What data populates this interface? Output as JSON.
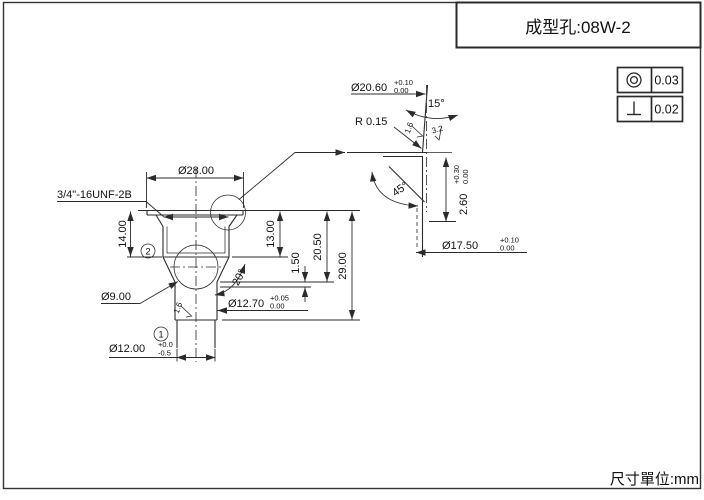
{
  "page": {
    "units_note": "尺寸單位:mm"
  },
  "title_block": {
    "title": "成型孔:08W-2"
  },
  "tolerance_frames": [
    {
      "symbol": "concentricity-icon",
      "value": "0.03"
    },
    {
      "symbol": "perpendicularity-icon",
      "value": "0.02"
    }
  ],
  "main_view": {
    "balloons": [
      {
        "label": "1"
      },
      {
        "label": "2"
      }
    ],
    "dims": {
      "d28": {
        "label": "Ø28.00"
      },
      "thread": {
        "label": "3/4\"-16UNF-2B"
      },
      "d14": {
        "label": "14.00"
      },
      "d13": {
        "label": "13.00"
      },
      "d150": {
        "label": "1.50"
      },
      "d2050": {
        "label": "20.50"
      },
      "d2900": {
        "label": "29.00"
      },
      "d9": {
        "label": "Ø9.00"
      },
      "d1270": {
        "label": "Ø12.70",
        "tol_plus": "+0.05",
        "tol_minus": "0.00"
      },
      "d1200": {
        "label": "Ø12.00",
        "tol_plus": "+0.0",
        "tol_minus": "-0.5"
      },
      "a20": {
        "label": "20°"
      },
      "rough16": {
        "label": "1.6"
      }
    }
  },
  "detail_view": {
    "dims": {
      "d2060": {
        "label": "Ø20.60",
        "tol_plus": "+0.10",
        "tol_minus": "0.00"
      },
      "a15": {
        "label": "15°"
      },
      "r015": {
        "label": "R 0.15"
      },
      "rough16": {
        "label": "1.6"
      },
      "rough32": {
        "label": "3.2"
      },
      "a45": {
        "label": "45°"
      },
      "d260": {
        "label": "2.60",
        "tol_plus": "+0.30",
        "tol_minus": "0.00"
      },
      "d1750": {
        "label": "Ø17.50",
        "tol_plus": "+0.10",
        "tol_minus": "0.00"
      }
    }
  },
  "colors": {
    "line": "#2b2b2b",
    "text": "#111111",
    "background": "#ffffff"
  }
}
